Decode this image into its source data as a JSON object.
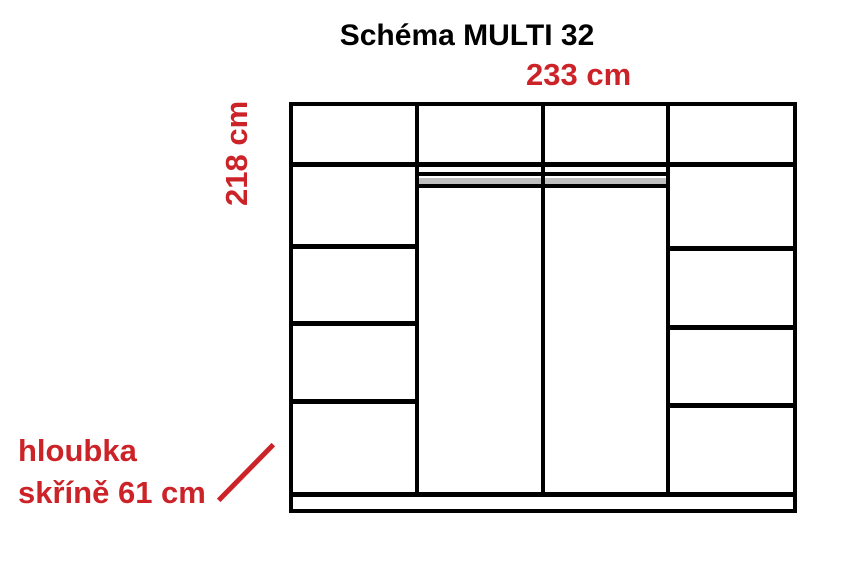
{
  "title": "Schéma MULTI 32",
  "dimensions": {
    "width": "233 cm",
    "height": "218 cm",
    "depth_line1": "hloubka",
    "depth_line2": "skříně 61 cm"
  },
  "colors": {
    "dimension_red": "#cc2329",
    "line_black": "#000000",
    "rail_gray": "#bfbfbf",
    "background": "#ffffff"
  },
  "diagram": {
    "type": "wardrobe-schematic",
    "columns": 4,
    "left_column_compartments": 5,
    "right_column_compartments": 5,
    "middle_bays": 2,
    "middle_bay_feature": "hanging-rail"
  }
}
